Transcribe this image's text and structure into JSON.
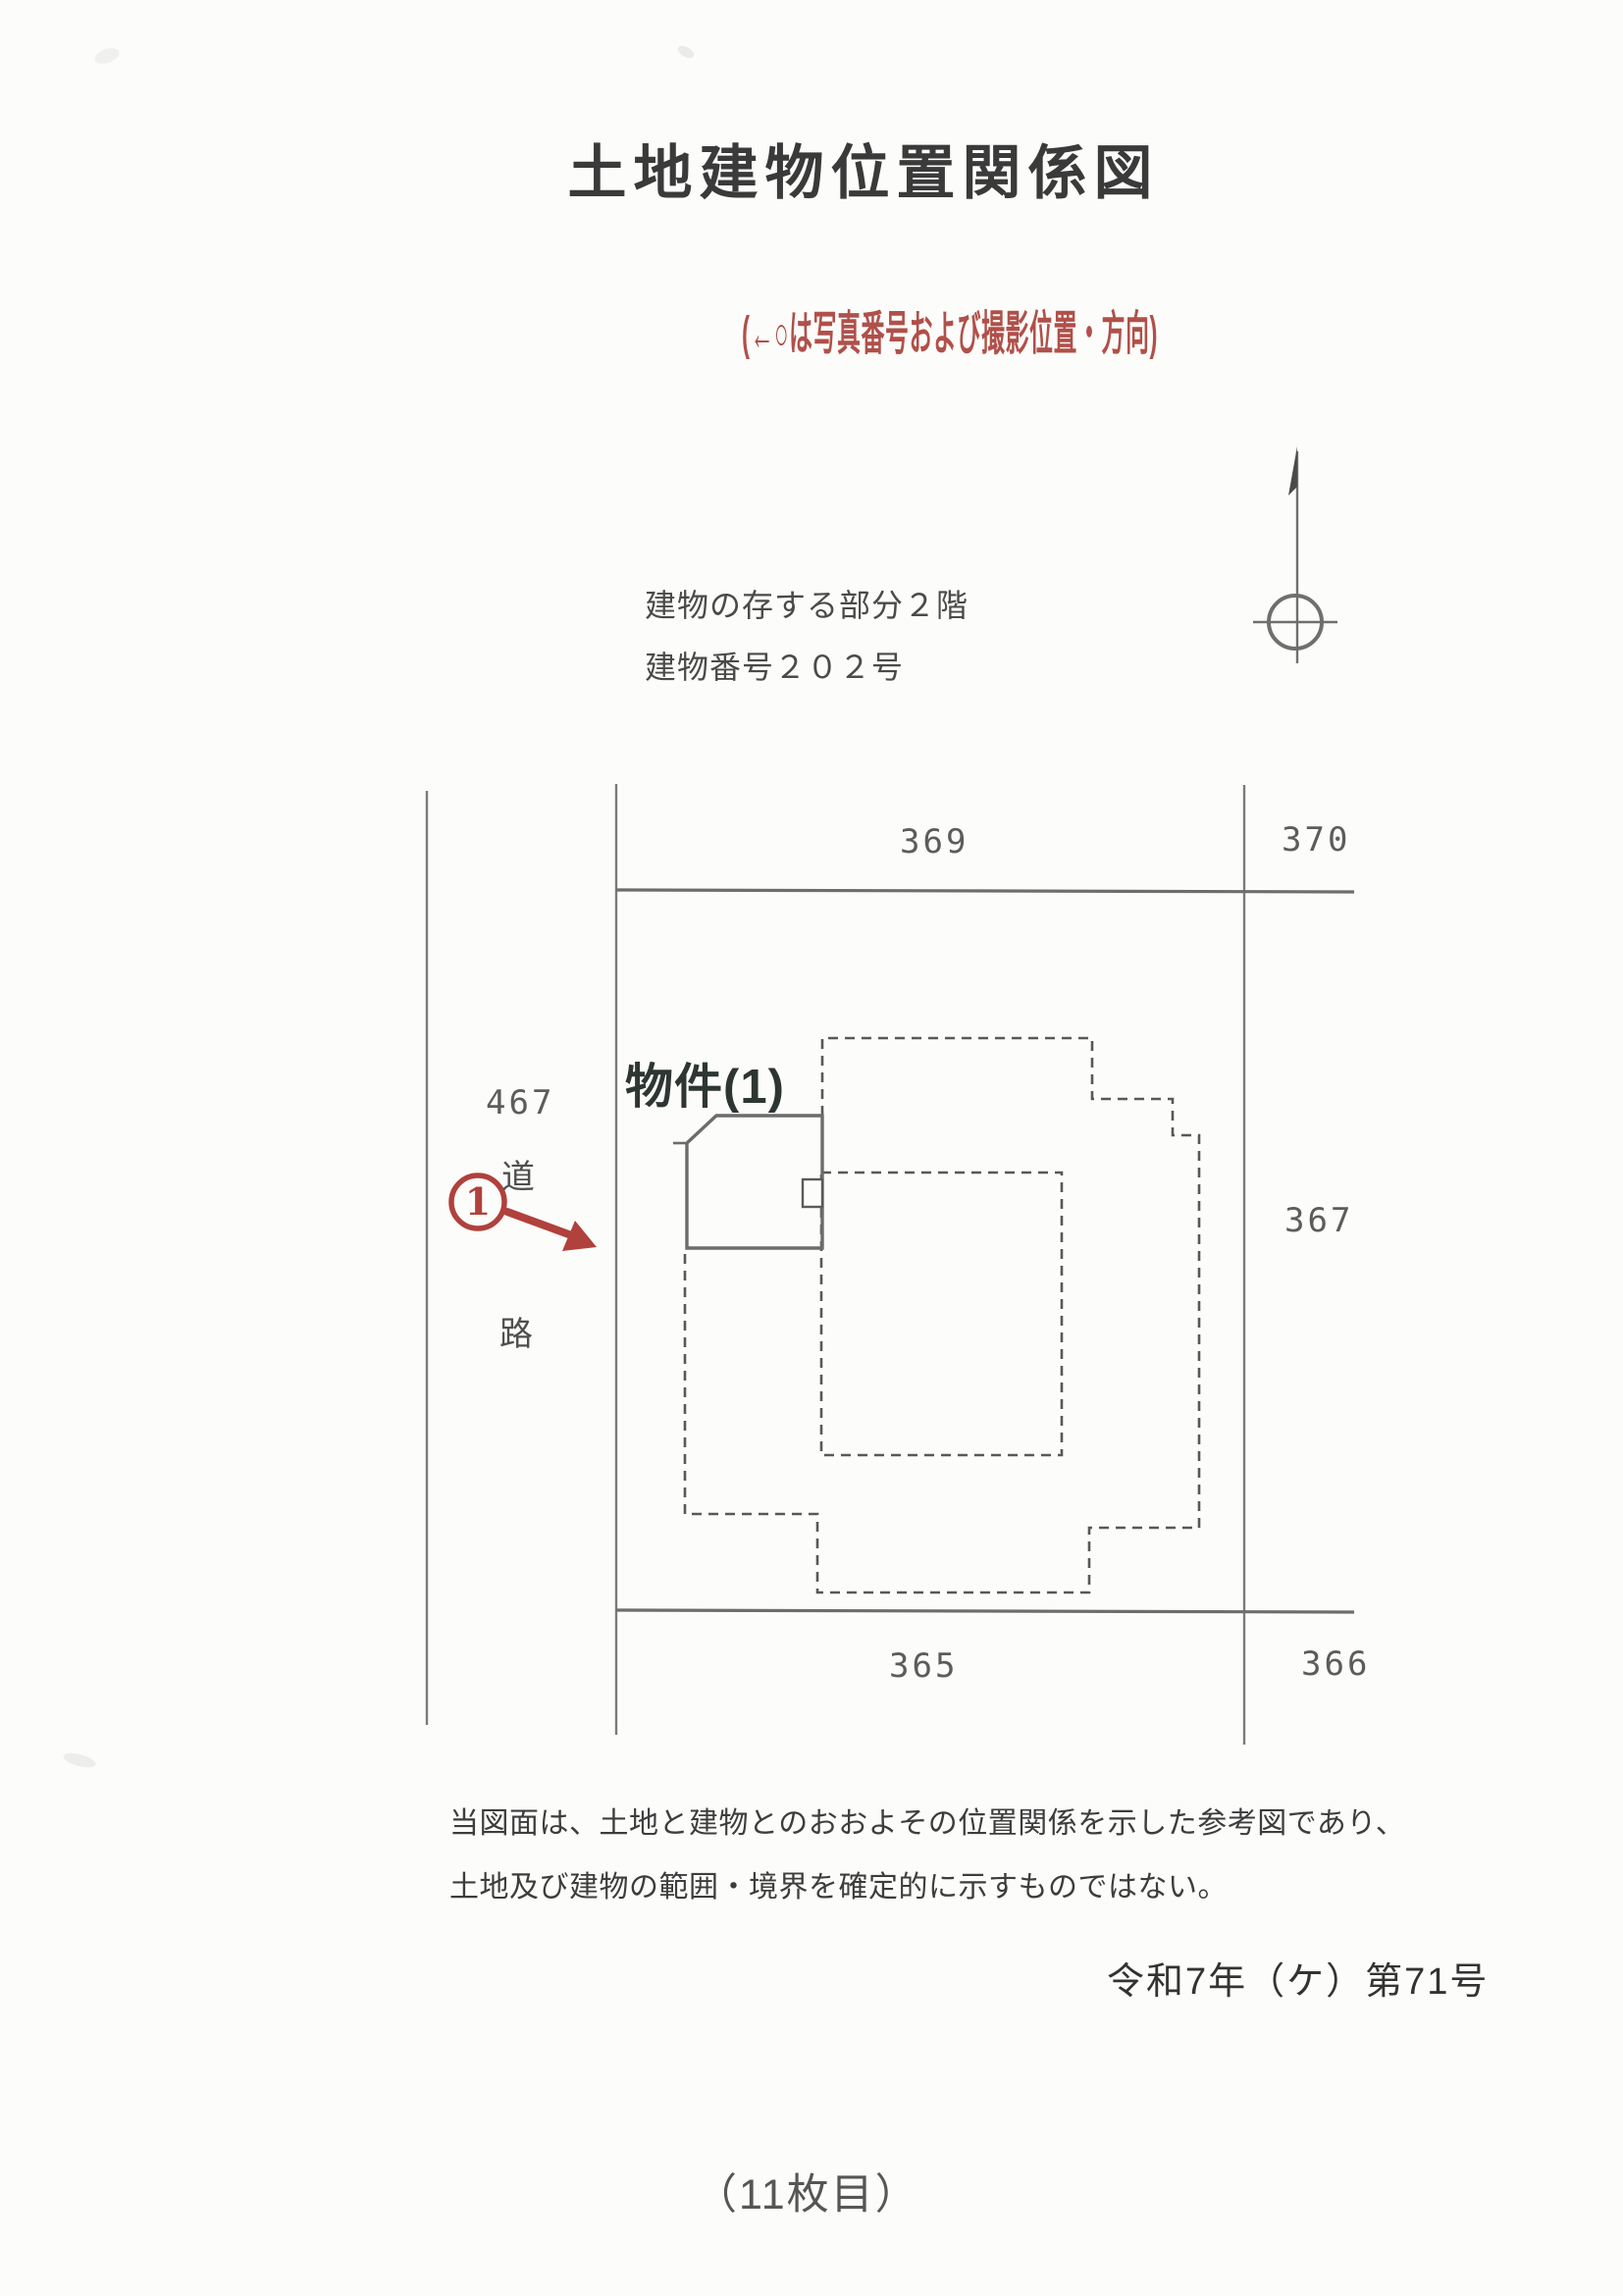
{
  "page": {
    "title": "土地建物位置関係図"
  },
  "photo_legend": "(←○は写真番号および撮影位置・方向)",
  "building_info": {
    "line1": "建物の存する部分２階",
    "line2": "建物番号２０２号"
  },
  "diagram": {
    "property_label": "物件(1)",
    "photo_marker_number": "1",
    "road_label": {
      "top": "道",
      "bottom": "路"
    },
    "parcels": {
      "p369": "369",
      "p370": "370",
      "p467": "467",
      "p367": "367",
      "p365": "365",
      "p366": "366"
    }
  },
  "disclaimer": {
    "line1": "当図面は、土地と建物とのおおよその位置関係を示した参考図であり、",
    "line2": "土地及び建物の範囲・境界を確定的に示すものではない。"
  },
  "case_number": "令和7年（ケ）第71号",
  "sheet_label": "（11枚目）",
  "colors": {
    "marker_red": "#b0413c",
    "line_gray": "#7b7b7b",
    "dash_gray": "#585858",
    "text_dark": "#3c3c3c"
  }
}
